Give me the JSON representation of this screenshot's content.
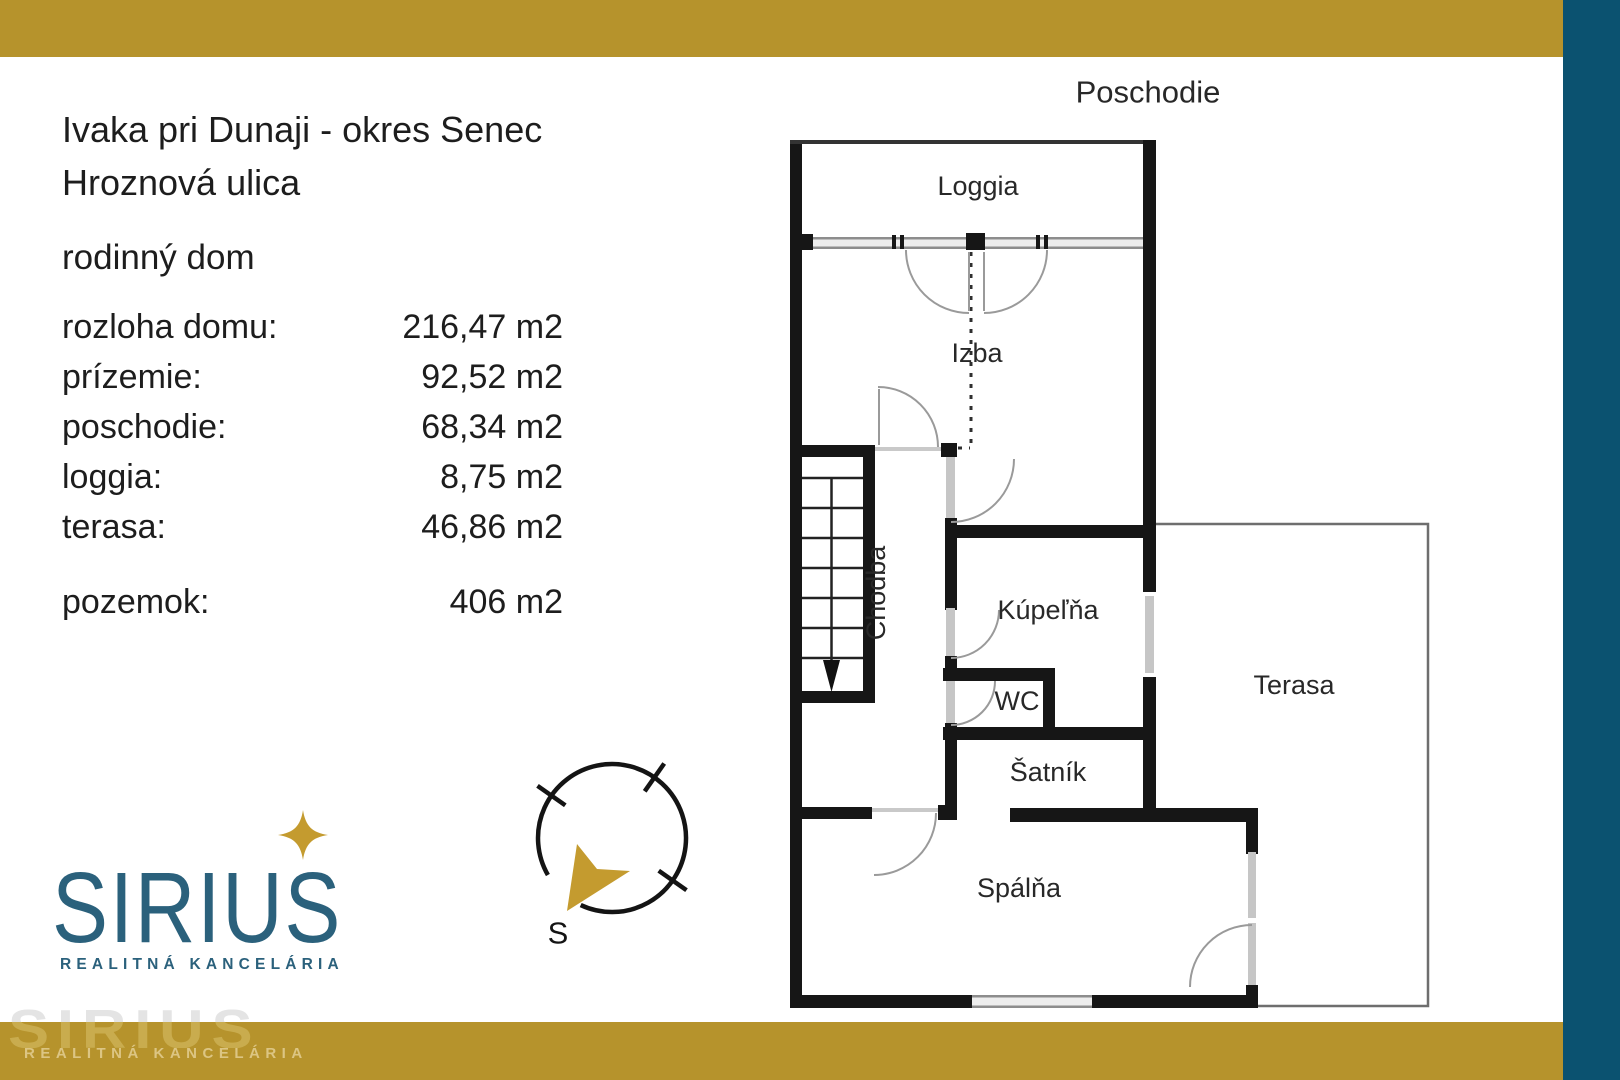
{
  "colors": {
    "accent_gold": "#b6932c",
    "accent_teal": "#0b5270",
    "logo_teal": "#2b617c",
    "star_gold": "#c49b2f"
  },
  "listing": {
    "location_line1": "Ivaka pri Dunaji - okres Senec",
    "location_line2": "Hroznová ulica",
    "property_type": "rodinný dom",
    "details": [
      {
        "label": "rozloha domu:",
        "value": "216,47 m2"
      },
      {
        "label": "prízemie:",
        "value": "92,52 m2"
      },
      {
        "label": "poschodie:",
        "value": "68,34 m2"
      },
      {
        "label": "loggia:",
        "value": "8,75 m2"
      },
      {
        "label": "terasa:",
        "value": "46,86 m2"
      },
      {
        "label": "pozemok:",
        "value": "406 m2"
      }
    ]
  },
  "floor_plan": {
    "title": "Poschodie",
    "labels": {
      "loggia": "Loggia",
      "izba": "Izba",
      "chodba": "Chodba",
      "kupelna": "Kúpeľňa",
      "wc": "WC",
      "satnik": "Šatník",
      "terasa": "Terasa",
      "spalna": "Spálňa"
    }
  },
  "compass": {
    "south_label": "S"
  },
  "logo": {
    "name": "SIRIUS",
    "tagline": "REALITNÁ KANCELÁRIA"
  },
  "watermark": {
    "name": "SIRIUS",
    "tagline": "REALITNÁ KANCELÁRIA"
  }
}
